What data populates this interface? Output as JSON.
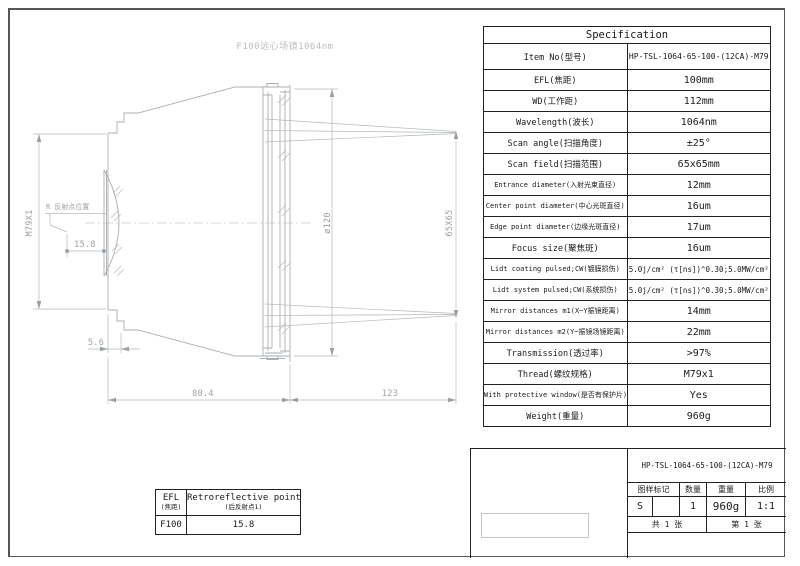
{
  "palette": {
    "line_gray": "#a9aeb2",
    "dim_text_gray": "#9aa0a4",
    "ink": "#1a1a1a"
  },
  "drawing": {
    "title": "F100远心场镜1064nm",
    "thread_dim": "M79X1",
    "reflect_label": "R 反射点位置",
    "reflect_offset": "15.8",
    "flange_offset": "5.6",
    "body_length": "80.4",
    "working_distance": "123",
    "window_diameter": "ø120",
    "scan_field": "65X65"
  },
  "spec_table": {
    "title": "Specification",
    "rows": [
      {
        "label": "Item No(型号)",
        "value": "HP-TSL-1064-65-100-(12CA)-M79"
      },
      {
        "label": "EFL(焦距)",
        "value": "100mm"
      },
      {
        "label": "WD(工作距)",
        "value": "112mm"
      },
      {
        "label": "Wavelength(波长)",
        "value": "1064nm"
      },
      {
        "label": "Scan angle(扫描角度)",
        "value": "±25°"
      },
      {
        "label": "Scan field(扫描范围)",
        "value": "65x65mm"
      },
      {
        "label": "Entrance diameter(入射光束直径)",
        "value": "12mm"
      },
      {
        "label": "Center point diameter(中心光斑直径)",
        "value": "16um"
      },
      {
        "label": "Edge point diameter(边缘光斑直径)",
        "value": "17um"
      },
      {
        "label": "Focus size(聚焦斑)",
        "value": "16um"
      },
      {
        "label": "Lidt coating pulsed;CW(镀膜损伤)",
        "value": "5.0j/cm² (τ[ns])^0.30;5.0MW/cm²"
      },
      {
        "label": "Lidt system pulsed;CW(系统损伤)",
        "value": "5.0j/cm² (τ[ns])^0.30;5.0MW/cm²"
      },
      {
        "label": "Mirror distances m1(X~Y振镜距离)",
        "value": "14mm"
      },
      {
        "label": "Mirror distances m2(Y~振镜场镜距离)",
        "value": "22mm"
      },
      {
        "label": "Transmission(透过率)",
        "value": ">97%"
      },
      {
        "label": "Thread(螺纹规格)",
        "value": "M79x1"
      },
      {
        "label": "With protective window(是否有保护片)",
        "value": "Yes"
      },
      {
        "label": "Weight(重量)",
        "value": "960g"
      }
    ]
  },
  "efl_table": {
    "h1_en": "EFL",
    "h1_cn": "(焦距)",
    "h2_en": "Retroreflective point1",
    "h2_cn": "(后反射点1)",
    "v1": "F100",
    "v2": "15.8"
  },
  "title_block": {
    "part_no": "HP-TSL-1064-65-100-(12CA)-M79",
    "h_mark": "图样标记",
    "h_qty": "数量",
    "h_weight": "重量",
    "h_scale": "比例",
    "v_mark": "S",
    "v_qty": "1",
    "v_weight": "960g",
    "v_scale": "1:1",
    "total_sheets": "共 1 张",
    "sheet_no": "第 1 张"
  }
}
